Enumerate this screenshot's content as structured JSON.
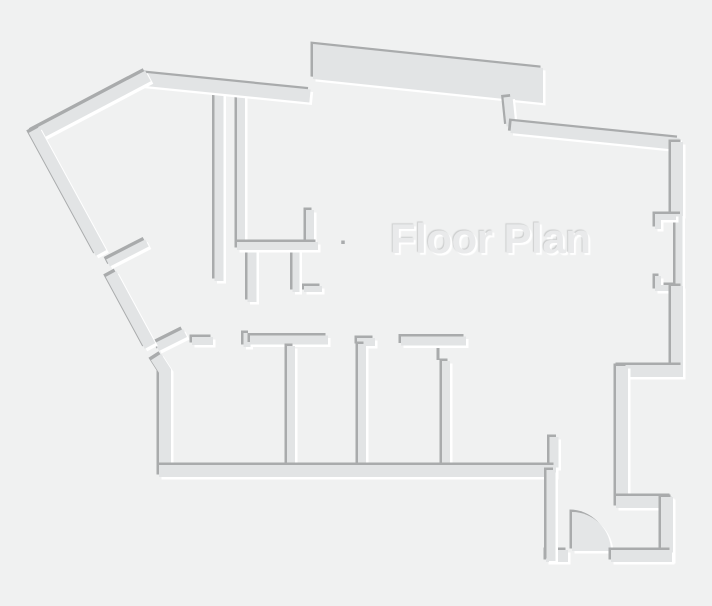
{
  "meta": {
    "canvas_width": 712,
    "canvas_height": 606
  },
  "title": {
    "text": "Floor Plan"
  },
  "palette": {
    "background": "#f0f1f1",
    "wall_fill": "#e2e4e5",
    "wall_fill_light": "#e4e6e7",
    "shadow_dark": "#a9abac",
    "shadow_light": "#ffffff",
    "title_fill": "#e9eaeb"
  },
  "plan": {
    "shadow_offset": 2.5,
    "title_pos": {
      "x": 390,
      "y": 253
    },
    "elements": [
      {
        "kind": "wall",
        "name": "wall-hanging-vertical",
        "w": 9,
        "pts": [
          [
            219,
            89
          ],
          [
            219,
            281
          ]
        ]
      },
      {
        "kind": "wall",
        "name": "closet-wall-left",
        "w": 8,
        "pts": [
          [
            241,
            90
          ],
          [
            241,
            247
          ]
        ]
      },
      {
        "kind": "wall",
        "name": "closet-stub-right",
        "w": 8,
        "pts": [
          [
            310,
            210
          ],
          [
            310,
            248
          ]
        ]
      },
      {
        "kind": "wall",
        "name": "fixture-stub-a",
        "w": 9,
        "pts": [
          [
            252,
            250
          ],
          [
            252,
            302
          ]
        ]
      },
      {
        "kind": "wall",
        "name": "fixture-foot",
        "w": 6,
        "pts": [
          [
            304,
            289
          ],
          [
            322,
            289
          ]
        ]
      },
      {
        "kind": "wall",
        "name": "fixture-stub-b",
        "w": 7,
        "pts": [
          [
            296,
            250
          ],
          [
            296,
            292
          ]
        ]
      },
      {
        "kind": "wall",
        "name": "closet-wall-bottom",
        "w": 8,
        "pts": [
          [
            237,
            246
          ],
          [
            318,
            246
          ]
        ]
      },
      {
        "kind": "wall",
        "name": "hall-wall-short-left",
        "w": 8,
        "pts": [
          [
            192,
            341
          ],
          [
            213,
            341
          ]
        ]
      },
      {
        "kind": "wall",
        "name": "hall-wall-jog-tick",
        "w": 7,
        "pts": [
          [
            247,
            347
          ],
          [
            247,
            333
          ]
        ]
      },
      {
        "kind": "wall",
        "name": "hall-wall-long-left",
        "w": 9,
        "pts": [
          [
            250,
            340
          ],
          [
            328,
            340
          ]
        ]
      },
      {
        "kind": "wall",
        "name": "room-partition-1",
        "w": 8,
        "pts": [
          [
            291,
            346
          ],
          [
            291,
            470
          ]
        ]
      },
      {
        "kind": "wall",
        "name": "room-partition-2-cap",
        "w": 8,
        "pts": [
          [
            357,
            342
          ],
          [
            375,
            342
          ]
        ]
      },
      {
        "kind": "wall",
        "name": "room-partition-2",
        "w": 8,
        "pts": [
          [
            362,
            344
          ],
          [
            362,
            470
          ]
        ]
      },
      {
        "kind": "wall",
        "name": "hall-wall-mid",
        "w": 9,
        "pts": [
          [
            401,
            341
          ],
          [
            466,
            341
          ]
        ]
      },
      {
        "kind": "wall",
        "name": "room-partition-3",
        "w": 8,
        "pts": [
          [
            446,
            361
          ],
          [
            446,
            470
          ]
        ]
      },
      {
        "kind": "wall",
        "name": "entry-wall-stub",
        "w": 9,
        "pts": [
          [
            554,
            437
          ],
          [
            554,
            468
          ]
        ]
      },
      {
        "kind": "path",
        "name": "door-swing-arc",
        "fill": "light",
        "d": "M572,512 A39,39 0 0 1 611,551 L572,551 Z"
      },
      {
        "kind": "wall",
        "name": "door-leaf-upper",
        "w": 8,
        "pts": [
          [
            108,
            263
          ],
          [
            147,
            243
          ]
        ]
      },
      {
        "kind": "wall",
        "name": "door-leaf-lower",
        "w": 9,
        "pts": [
          [
            157,
            347
          ],
          [
            185,
            333
          ]
        ]
      },
      {
        "kind": "polygon",
        "name": "exterior-band-top",
        "pts": [
          [
            313,
            44
          ],
          [
            543,
            68
          ],
          [
            543,
            103
          ],
          [
            313,
            79
          ]
        ]
      },
      {
        "kind": "wall",
        "name": "exterior-jog",
        "w": 9,
        "pts": [
          [
            508,
            97
          ],
          [
            511,
            126
          ]
        ]
      },
      {
        "kind": "wall",
        "name": "exterior-top-right-wall",
        "w": 12,
        "pts": [
          [
            511,
            127
          ],
          [
            679,
            144
          ]
        ]
      },
      {
        "kind": "wall",
        "name": "exterior-top-left-wall",
        "w": 13,
        "pts": [
          [
            141,
            79
          ],
          [
            310,
            96
          ]
        ]
      },
      {
        "kind": "wall",
        "name": "exterior-apex-diagonal",
        "w": 12,
        "pts": [
          [
            148,
            76
          ],
          [
            34,
            136
          ]
        ]
      },
      {
        "kind": "wall",
        "name": "exterior-diagonal-upper",
        "w": 12,
        "pts": [
          [
            34,
            130
          ],
          [
            101,
            253
          ]
        ]
      },
      {
        "kind": "wall",
        "name": "exterior-diagonal-lower",
        "w": 12,
        "pts": [
          [
            111,
            274
          ],
          [
            150,
            346
          ]
        ]
      },
      {
        "kind": "wall",
        "name": "exterior-left-corner-wall",
        "w": 12,
        "pts": [
          [
            156,
            357
          ],
          [
            165,
            371
          ],
          [
            165,
            477
          ]
        ]
      },
      {
        "kind": "wall",
        "name": "exterior-bottom-wall",
        "w": 12,
        "pts": [
          [
            159,
            471
          ],
          [
            556,
            471
          ]
        ]
      },
      {
        "kind": "wall",
        "name": "exterior-right-wall-upper",
        "w": 12,
        "pts": [
          [
            677,
            142
          ],
          [
            677,
            216
          ]
        ]
      },
      {
        "kind": "wall",
        "name": "window-pane",
        "w": 7,
        "pts": [
          [
            679,
            214
          ],
          [
            679,
            290
          ]
        ]
      },
      {
        "kind": "wall",
        "name": "window-jamb-top",
        "w": 6,
        "pts": [
          [
            676,
            217
          ],
          [
            658,
            217
          ],
          [
            658,
            229
          ]
        ]
      },
      {
        "kind": "wall",
        "name": "window-jamb-bottom",
        "w": 6,
        "pts": [
          [
            676,
            288
          ],
          [
            658,
            288
          ],
          [
            658,
            276
          ]
        ]
      },
      {
        "kind": "wall",
        "name": "exterior-right-wall-lower",
        "w": 12,
        "pts": [
          [
            677,
            286
          ],
          [
            677,
            377
          ]
        ]
      },
      {
        "kind": "wall",
        "name": "recess-step-top",
        "w": 12,
        "pts": [
          [
            683,
            371
          ],
          [
            618,
            371
          ]
        ]
      },
      {
        "kind": "wall",
        "name": "recess-step-left",
        "w": 12,
        "pts": [
          [
            622,
            366
          ],
          [
            622,
            508
          ]
        ]
      },
      {
        "kind": "wall",
        "name": "recess-step-bottom",
        "w": 12,
        "pts": [
          [
            616,
            502
          ],
          [
            672,
            502
          ]
        ]
      },
      {
        "kind": "wall",
        "name": "entry-room-right-wall",
        "w": 12,
        "pts": [
          [
            667,
            497
          ],
          [
            667,
            561
          ]
        ]
      },
      {
        "kind": "wall",
        "name": "entry-room-bottom-left",
        "w": 12,
        "pts": [
          [
            546,
            556
          ],
          [
            568,
            556
          ]
        ]
      },
      {
        "kind": "wall",
        "name": "entry-room-bottom-right",
        "w": 12,
        "pts": [
          [
            611,
            556
          ],
          [
            672,
            556
          ]
        ]
      },
      {
        "kind": "wall",
        "name": "entry-room-left-wall",
        "w": 9,
        "pts": [
          [
            551,
            470
          ],
          [
            551,
            561
          ]
        ]
      },
      {
        "kind": "mark",
        "name": "door-hinge-tick",
        "w": 3,
        "pts": [
          [
            438,
            348
          ],
          [
            438,
            360
          ]
        ]
      },
      {
        "kind": "mark",
        "name": "wall-corner-dot",
        "w": 3.5,
        "pts": [
          [
            343,
            240.5
          ],
          [
            343,
            244
          ]
        ]
      }
    ]
  }
}
